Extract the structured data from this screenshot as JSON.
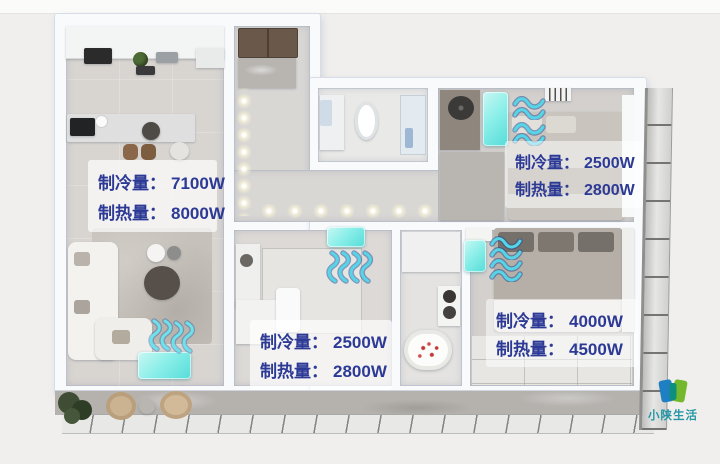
{
  "ac_labels": [
    {
      "room": "living-dining",
      "cooling_label": "制冷量：",
      "cooling_value": "7100W",
      "heating_label": "制热量：",
      "heating_value": "8000W"
    },
    {
      "room": "bedroom-top-right",
      "cooling_label": "制冷量：",
      "cooling_value": "2500W",
      "heating_label": "制热量：",
      "heating_value": "2800W"
    },
    {
      "room": "middle-room",
      "cooling_label": "制冷量：",
      "cooling_value": "2500W",
      "heating_label": "制热量：",
      "heating_value": "2800W"
    },
    {
      "room": "master-bedroom",
      "cooling_label": "制冷量：",
      "cooling_value": "4000W",
      "heating_label": "制热量：",
      "heating_value": "4500W"
    }
  ],
  "watermark": {
    "brand": "小陕生活"
  },
  "colors": {
    "label_text": "#2c3a96",
    "ac_unit_fill": "#8defe9",
    "airflow_wave": "#5ed9e8",
    "logo_blue": "#1e7fc2",
    "logo_green": "#74b82c",
    "logo_text": "#2496a5"
  }
}
